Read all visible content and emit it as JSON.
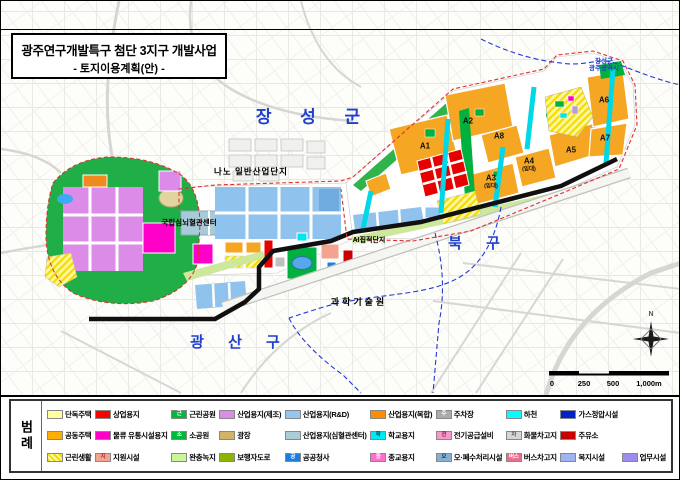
{
  "title": {
    "line1": "광주연구개발특구 첨단 3지구 개발사업",
    "line2": "- 토지이용계획(안) -"
  },
  "map": {
    "regions": {
      "jangseong": "장 성 군",
      "bukgu": "북 구",
      "gwangsan": "광 산 구"
    },
    "admin_boundary_label": {
      "line1": "장성군",
      "line2": "광주광역시"
    },
    "sites": {
      "nano": "나노 일반산업단지",
      "cardio": "국립심뇌혈관센터",
      "ai": "AI집적단지",
      "gist": "과학기술원"
    },
    "blocks": {
      "a1": "A1",
      "a2": "A2",
      "a3": "A3",
      "a3_sub": "(임대)",
      "a4": "A4",
      "a4_sub": "(임대)",
      "a5": "A5",
      "a6": "A6",
      "a7": "A7",
      "a8": "A8"
    },
    "north": "N",
    "scale_ticks": [
      "0",
      "250",
      "500",
      "1,000m"
    ]
  },
  "legend": {
    "title": "범례",
    "rows": [
      [
        {
          "label": "단독주택",
          "color": "#FFFF9C"
        },
        {
          "label": "상업용지",
          "color": "#FF0000"
        },
        {
          "label": "근린공원",
          "color": "#00B93C",
          "glyph": "근"
        },
        {
          "label": "산업용지(제조)",
          "color": "#DD8BE4"
        },
        {
          "label": "산업용지(R&D)",
          "color": "#92C6F0"
        },
        {
          "label": "산업용지(복합)",
          "color": "#FF8C00"
        },
        {
          "label": "주차장",
          "color": "#ABABAB",
          "glyph": "주"
        },
        {
          "label": "하천",
          "color": "#00FFFF"
        },
        {
          "label": "가스정압시설",
          "color": "#0022CC"
        }
      ],
      [
        {
          "label": "공동주택",
          "color": "#FFAE00"
        },
        {
          "label": "물류 유통시설용지",
          "color": "#FF00C8"
        },
        {
          "label": "소공원",
          "color": "#00B93C",
          "glyph": "소"
        },
        {
          "label": "광장",
          "color": "#D2B469"
        },
        {
          "label": "산업용지(심혈관센터)",
          "color": "#ABCBD6"
        },
        {
          "label": "학교용지",
          "color": "#00E8F0",
          "glyph": "학",
          "glyph_color": "#004466"
        },
        {
          "label": "전기공급설비",
          "color": "#F49AC8",
          "glyph": "전",
          "glyph_color": "#8B1A4F"
        },
        {
          "label": "화물차고지",
          "color": "#D6D6D6",
          "glyph": "차",
          "glyph_color": "#555555"
        },
        {
          "label": "주유소",
          "color": "#C80000"
        }
      ],
      [
        {
          "label": "근린생활",
          "hatch": true
        },
        {
          "label": "지원시설",
          "color": "#F2A48E",
          "glyph": "지",
          "glyph_color": "#A03325"
        },
        {
          "label": "완충녹지",
          "color": "#CCF49C"
        },
        {
          "label": "보행자도로",
          "color": "#8CB400"
        },
        {
          "label": "공공청사",
          "color": "#1B7FE0",
          "glyph": "공"
        },
        {
          "label": "종교용지",
          "color": "#FF6EC8",
          "glyph": "종"
        },
        {
          "label": "오·폐수처리시설",
          "color": "#86AFD4",
          "glyph": "오",
          "glyph_color": "#1A3A6B"
        },
        {
          "label": "버스차고지",
          "color": "#E8708C",
          "glyph": "버스"
        },
        {
          "label": "복지시설",
          "color": "#9FB4F0"
        },
        {
          "label": "업무시설",
          "color": "#9C8CF0"
        }
      ]
    ]
  }
}
